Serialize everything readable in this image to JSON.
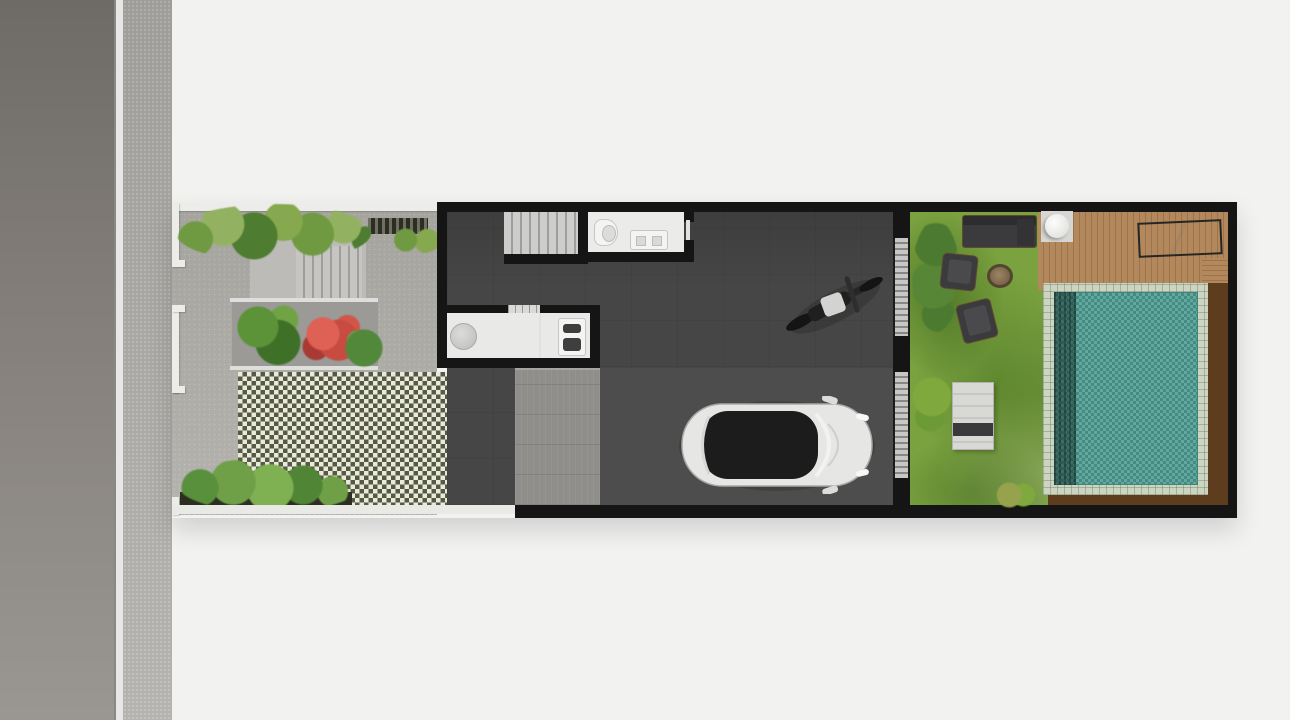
{
  "scene": {
    "type": "floor-plan-render",
    "view": "top-down",
    "subject": "Narrow townhouse ground-floor site plan: street and sidewalk on the left, paved front courtyard garden with hedges and grass-block pavers, dark open-plan interior with staircase, bathroom, kitchen island, parked car and motorcycle, and a rear garden with lawn, lounge furniture, timber deck and swimming pool"
  },
  "colors": {
    "bg": "#f2f2f1",
    "road_dark": "#6e6b67",
    "road_light": "#9a9793",
    "curb": "#e8e7e5",
    "sidewalk_top": "#a9a7a3",
    "paving": "#aeaca7",
    "paving_light": "#bcbbb7",
    "steps": "#c6c5c1",
    "step_line": "#9e9e9c",
    "wall": "#151515",
    "white_wall": "#ecece9",
    "floor": "#464646",
    "garage": "#4f4f4f",
    "stairs": "#cdcdcb",
    "room": "#ebebe9",
    "counter": "#e9e9e7",
    "checker_light": "#e9e9e0",
    "checker_dark": "#565a40",
    "pad": "#8f8e8a",
    "lawn": "#7aa23f",
    "deck": "#b3885c",
    "deck_line": "#9c744a",
    "water": "#4d9a90",
    "coping": "#ccd5c1",
    "wood": "#5e3c1e",
    "sofa": "#3b3b3d",
    "trim": "#62492e",
    "glass": "#c7c7c5",
    "glass_rung": "#878785",
    "planter": "#2c2e22",
    "red_bush": "#c84b42",
    "car_body": "#e6e6e4",
    "car_glass": "#1c1c1c"
  },
  "street": {
    "elements": [
      "asphalt-road",
      "curb-line",
      "sidewalk"
    ]
  },
  "front_garden": {
    "elements": [
      "boundary-wall",
      "hedge",
      "entry-steps",
      "vent-grate",
      "planter-bed",
      "green-plant",
      "flowering-red-bush",
      "grass-block-pavers",
      "fern-border",
      "stone-paving"
    ]
  },
  "house": {
    "elements": [
      "perimeter-walls",
      "staircase",
      "bathroom",
      "toilet",
      "vanity-sink",
      "kitchen-island",
      "round-basin",
      "cooktop-sink",
      "door-threshold",
      "concrete-patio",
      "garage-floor",
      "white-car",
      "motorcycle",
      "glass-sliding-doors"
    ]
  },
  "back_garden": {
    "elements": [
      "lawn",
      "shade-trees",
      "outdoor-sofa",
      "armchairs",
      "fire-pit",
      "bench-table",
      "shrubs",
      "timber-deck",
      "round-side-table",
      "sun-lounger",
      "swimming-pool",
      "pool-coping",
      "timber-pool-edge"
    ]
  }
}
